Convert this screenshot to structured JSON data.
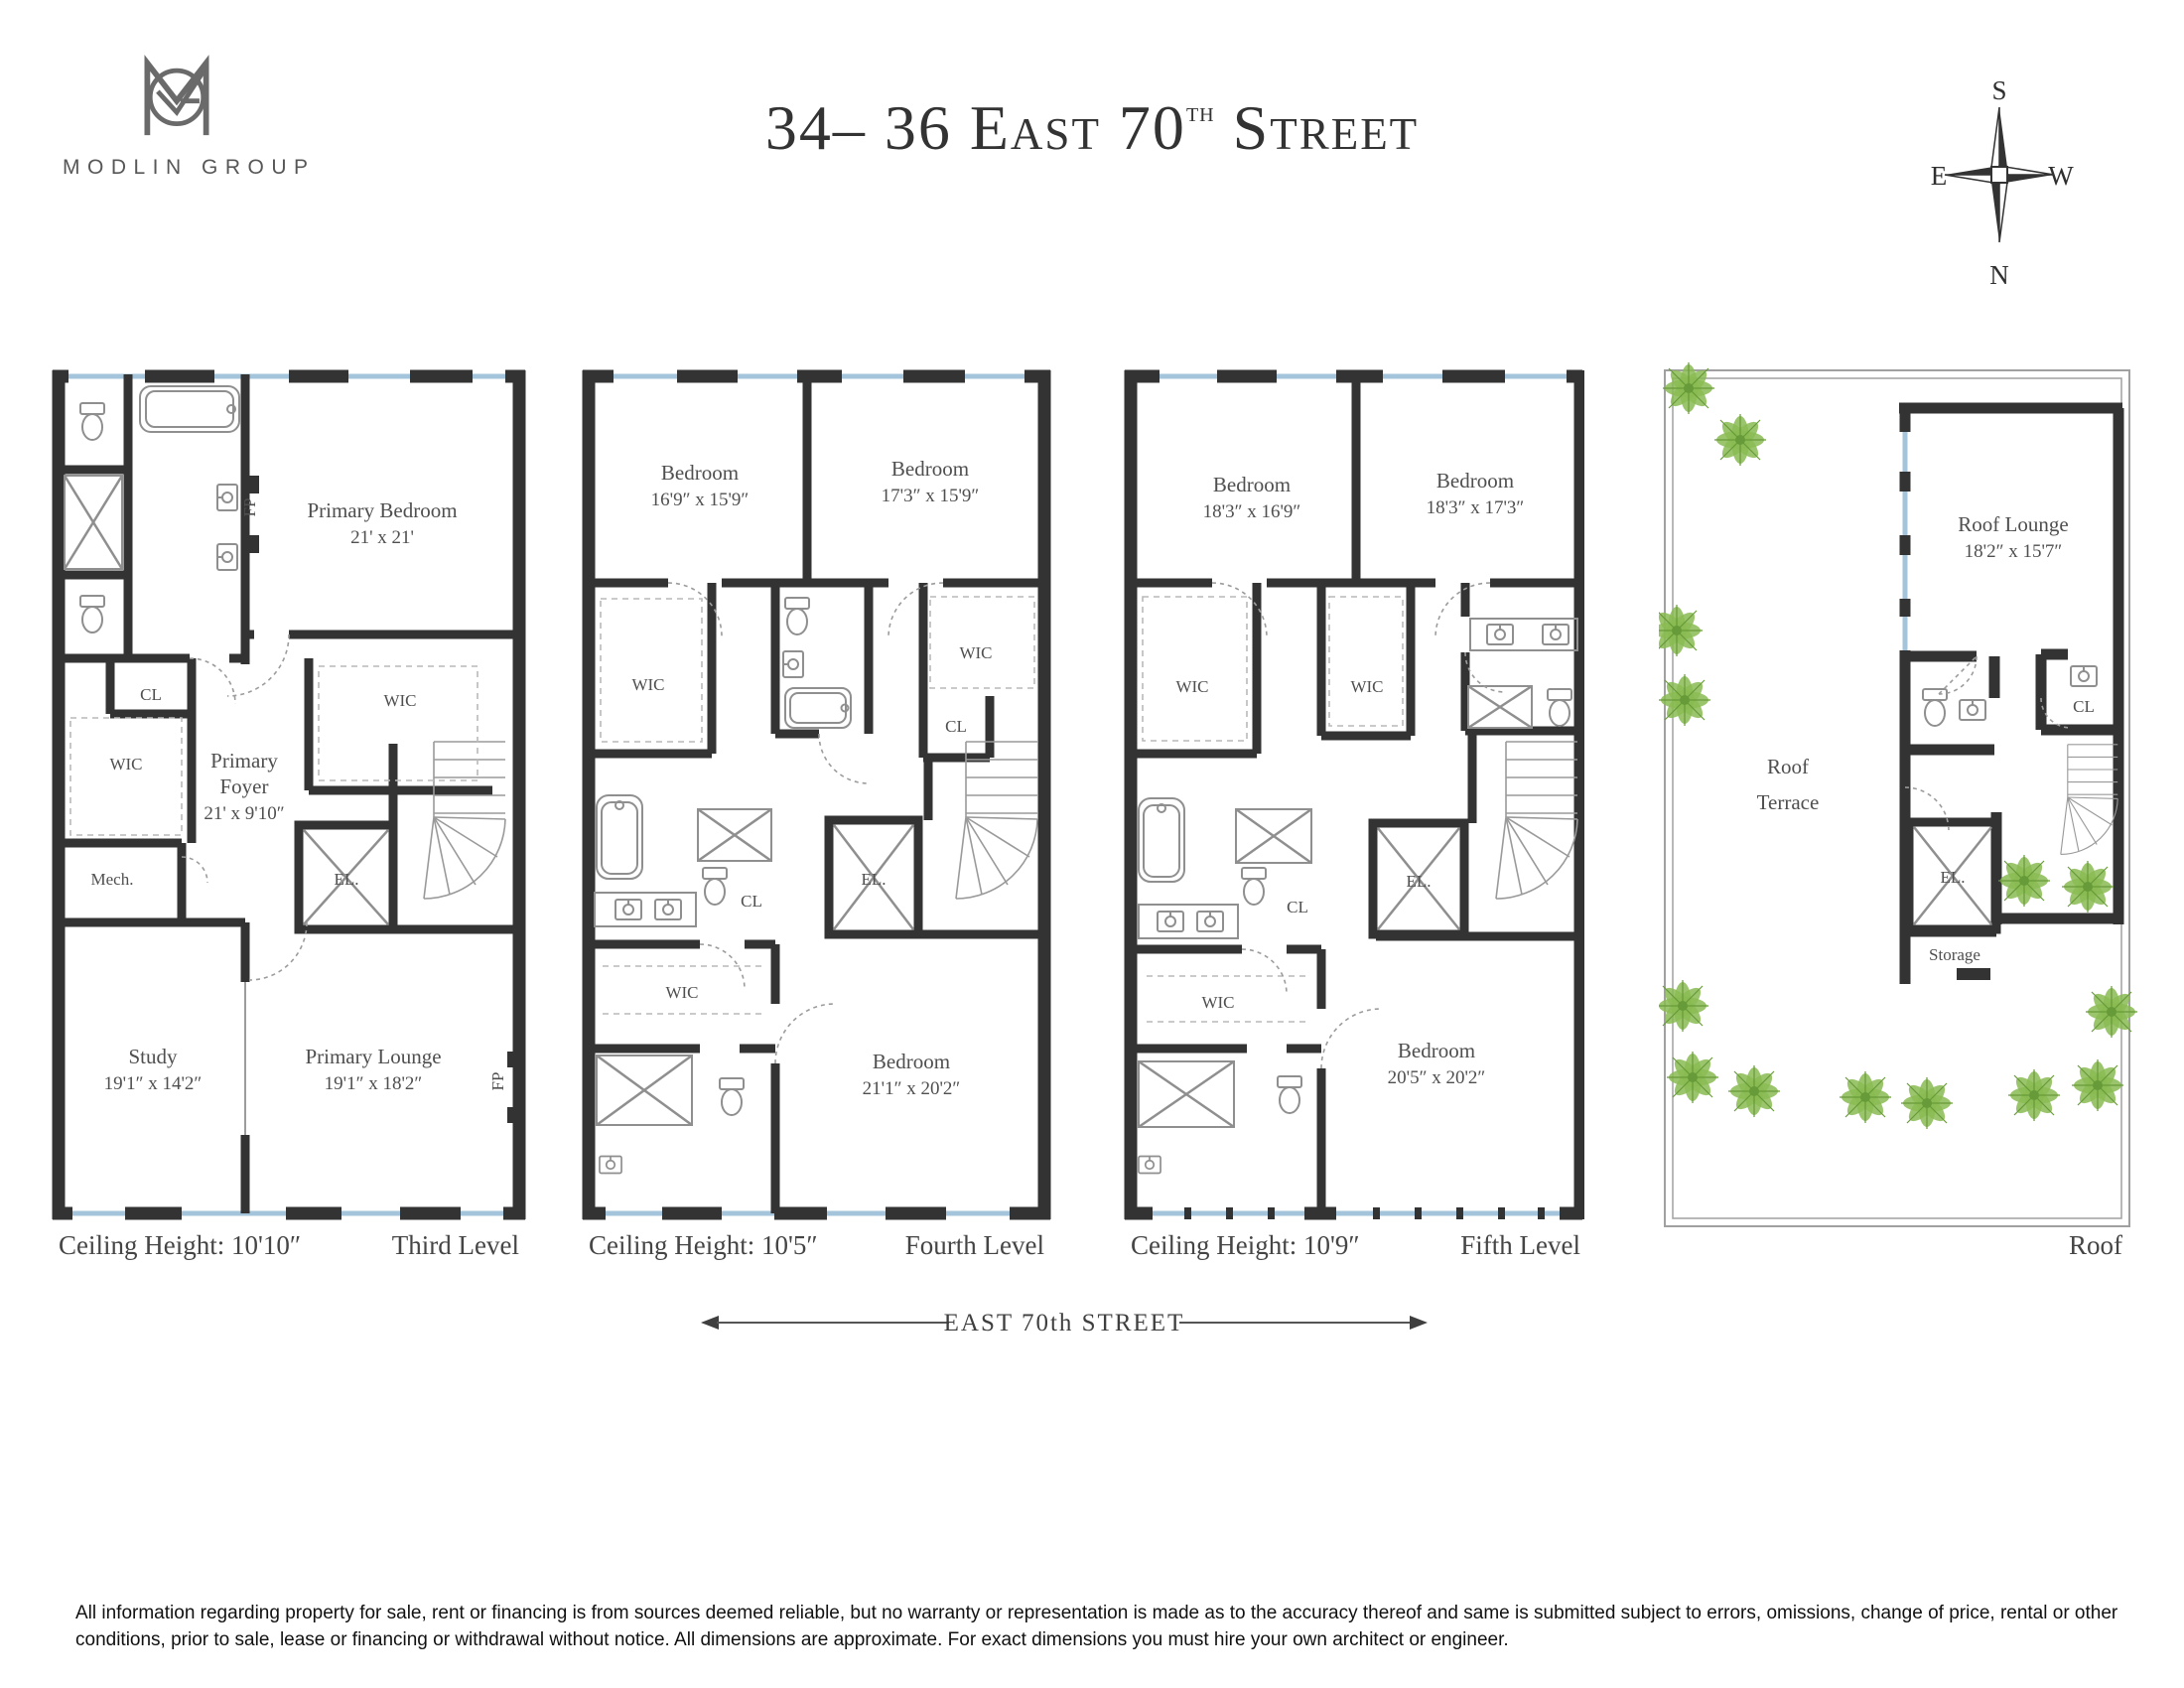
{
  "colors": {
    "wall": "#333333",
    "window": "#a3c4da",
    "plant": "#86b94e",
    "text": "#4f4f4f"
  },
  "header": {
    "logo": {
      "text": "MODLIN GROUP"
    },
    "title": {
      "prefix": "34– 36 East 70",
      "sup": "th",
      "suffix": " Street"
    },
    "compass": {
      "top": "S",
      "bottom": "N",
      "left": "E",
      "right": "W"
    }
  },
  "plans": [
    {
      "name": "Third Level",
      "ceiling": "Ceiling Height: 10'10″",
      "level": "Third Level",
      "rooms": [
        {
          "lines": [
            "Primary Bedroom",
            "21' x 21'"
          ]
        },
        {
          "lines": [
            "CL"
          ]
        },
        {
          "lines": [
            "WIC"
          ]
        },
        {
          "lines": [
            "WIC"
          ]
        },
        {
          "lines": [
            "Primary",
            "Foyer",
            "21' x 9'10″"
          ]
        },
        {
          "lines": [
            "Mech."
          ]
        },
        {
          "lines": [
            "EL."
          ]
        },
        {
          "lines": [
            "Study",
            "19'1″ x 14'2″"
          ]
        },
        {
          "lines": [
            "Primary Lounge",
            "19'1″ x 18'2″"
          ]
        },
        {
          "lines": [
            "FP"
          ]
        },
        {
          "lines": [
            "FP"
          ]
        }
      ]
    },
    {
      "name": "Fourth Level",
      "ceiling": "Ceiling Height: 10'5″",
      "level": "Fourth Level",
      "rooms": [
        {
          "lines": [
            "Bedroom",
            "16'9″ x 15'9″"
          ]
        },
        {
          "lines": [
            "Bedroom",
            "17'3″ x 15'9″"
          ]
        },
        {
          "lines": [
            "WIC"
          ]
        },
        {
          "lines": [
            "WIC"
          ]
        },
        {
          "lines": [
            "CL"
          ]
        },
        {
          "lines": [
            "CL"
          ]
        },
        {
          "lines": [
            "EL."
          ]
        },
        {
          "lines": [
            "WIC"
          ]
        },
        {
          "lines": [
            "Bedroom",
            "21'1″ x 20'2″"
          ]
        }
      ]
    },
    {
      "name": "Fifth Level",
      "ceiling": "Ceiling Height: 10'9″",
      "level": "Fifth Level",
      "rooms": [
        {
          "lines": [
            "Bedroom",
            "18'3″ x 16'9″"
          ]
        },
        {
          "lines": [
            "Bedroom",
            "18'3″ x 17'3″"
          ]
        },
        {
          "lines": [
            "WIC"
          ]
        },
        {
          "lines": [
            "WIC"
          ]
        },
        {
          "lines": [
            "CL"
          ]
        },
        {
          "lines": [
            "EL."
          ]
        },
        {
          "lines": [
            "WIC"
          ]
        },
        {
          "lines": [
            "Bedroom",
            "20'5″ x 20'2″"
          ]
        }
      ]
    },
    {
      "name": "Roof",
      "level": "Roof",
      "rooms": [
        {
          "lines": [
            "Roof Lounge",
            "18'2″ x 15'7″"
          ]
        },
        {
          "lines": [
            "CL"
          ]
        },
        {
          "lines": [
            "EL."
          ]
        },
        {
          "lines": [
            "Storage"
          ]
        },
        {
          "lines": [
            "Roof",
            "Terrace"
          ]
        }
      ]
    }
  ],
  "street": {
    "label": "EAST 70th STREET"
  },
  "disclaimer": "All information regarding property for sale, rent or financing is from sources deemed reliable, but no warranty or representation is made as to the accuracy thereof and same is submitted subject to errors, omissions, change of price, rental or other conditions, prior to sale, lease or financing or withdrawal without notice. All dimensions are approximate. For exact dimensions you must hire your own architect or engineer."
}
